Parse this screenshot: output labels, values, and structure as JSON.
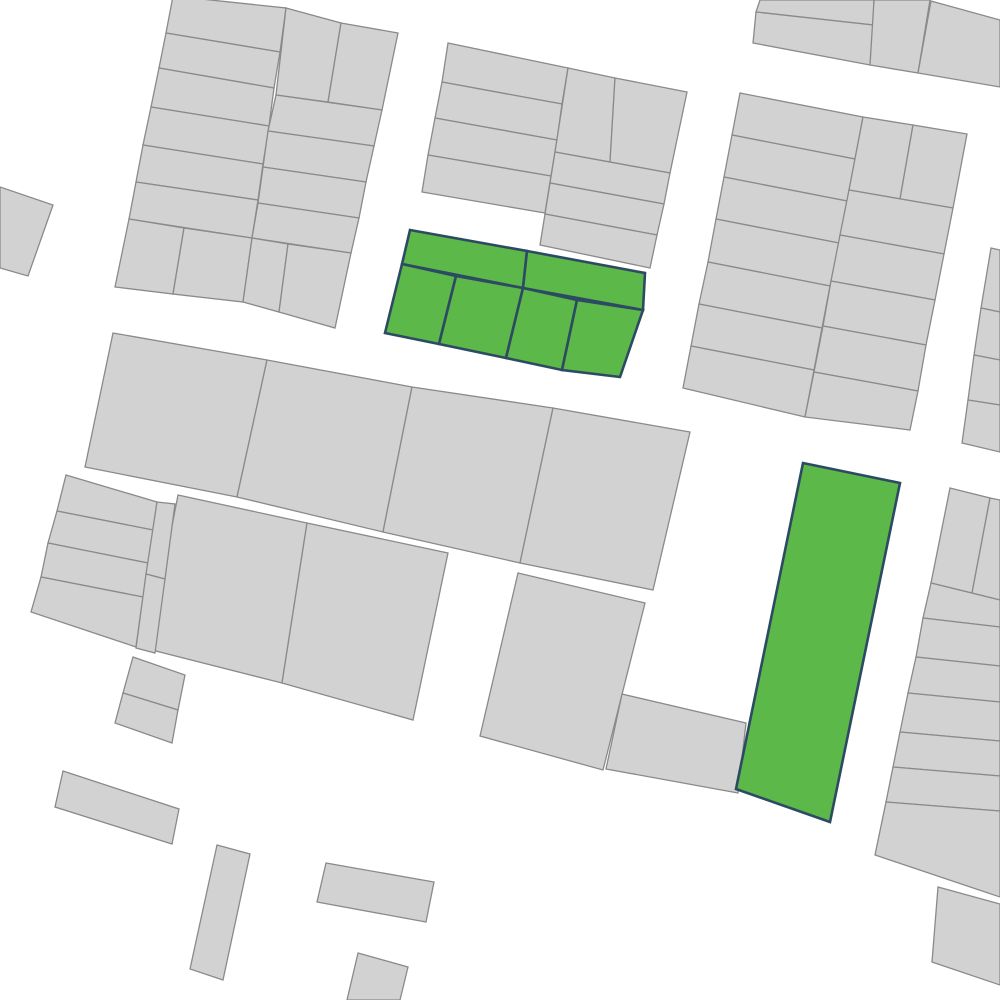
{
  "map": {
    "description": "cadastral-parcel-map",
    "background": "#ffffff",
    "colors": {
      "parcel_fill": "#d2d2d2",
      "parcel_stroke": "#8a8a8a",
      "highlight_fill": "#5cb848",
      "highlight_stroke": "#2d4a63"
    },
    "stroke": {
      "parcel_width": 1.3,
      "highlight_width": 2.6
    },
    "parcels": [
      {
        "id": "west-edge-1",
        "type": "standard",
        "points": "0,187 53,205 28,276 0,268"
      },
      {
        "id": "block-a-left-s1",
        "type": "standard",
        "points": "173,-4 286,8 280,52 166,33"
      },
      {
        "id": "block-a-left-s2",
        "type": "standard",
        "points": "166,33 280,52 274,88 159,68"
      },
      {
        "id": "block-a-left-s3",
        "type": "standard",
        "points": "159,68 274,88 269,126 151,107"
      },
      {
        "id": "block-a-left-s4",
        "type": "standard",
        "points": "151,107 269,126 263,164 143,145"
      },
      {
        "id": "block-a-left-s5",
        "type": "standard",
        "points": "143,145 263,164 258,200 136,182"
      },
      {
        "id": "block-a-left-s6",
        "type": "standard",
        "points": "136,182 258,200 252,238 129,219"
      },
      {
        "id": "block-a-left-b1",
        "type": "standard",
        "points": "129,219 184,228 173,294 115,287"
      },
      {
        "id": "block-a-left-b2",
        "type": "standard",
        "points": "184,228 252,238 243,302 173,294"
      },
      {
        "id": "block-a-right-p1",
        "type": "standard",
        "points": "286,8 341,23 328,102 276,95"
      },
      {
        "id": "block-a-right-p2",
        "type": "standard",
        "points": "341,23 398,33 382,110 328,102"
      },
      {
        "id": "block-a-right-s1",
        "type": "standard",
        "points": "276,95 382,110 374,146 268,131"
      },
      {
        "id": "block-a-right-s2",
        "type": "standard",
        "points": "268,131 374,146 366,182 263,167"
      },
      {
        "id": "block-a-right-s3",
        "type": "standard",
        "points": "263,167 366,182 359,218 258,203"
      },
      {
        "id": "block-a-right-s4",
        "type": "standard",
        "points": "258,203 359,218 351,253 252,238"
      },
      {
        "id": "block-a-right-b1",
        "type": "standard",
        "points": "252,238 288,244 279,312 243,302"
      },
      {
        "id": "block-a-right-b2",
        "type": "standard",
        "points": "288,244 351,253 335,328 279,312"
      },
      {
        "id": "block-b-left-s1",
        "type": "standard",
        "points": "448,43 568,68 562,104 442,82"
      },
      {
        "id": "block-b-left-s2",
        "type": "standard",
        "points": "442,82 562,104 557,140 435,118"
      },
      {
        "id": "block-b-left-s3",
        "type": "standard",
        "points": "435,118 557,140 551,176 428,155"
      },
      {
        "id": "block-b-left-s4",
        "type": "standard",
        "points": "428,155 551,176 545,213 422,192"
      },
      {
        "id": "block-b-right-p1",
        "type": "standard",
        "points": "568,68 615,78 610,162 555,152"
      },
      {
        "id": "block-b-right-p2",
        "type": "standard",
        "points": "615,78 687,92 670,173 610,162"
      },
      {
        "id": "block-b-right-s1",
        "type": "standard",
        "points": "555,152 670,173 664,204 550,183"
      },
      {
        "id": "block-b-right-s2",
        "type": "standard",
        "points": "550,183 664,204 657,235 545,214"
      },
      {
        "id": "block-b-right-s3",
        "type": "standard",
        "points": "545,214 657,235 650,268 540,245"
      },
      {
        "id": "block-ne-top-s1",
        "type": "standard",
        "points": "760,0 874,0 873,25 756,12"
      },
      {
        "id": "block-ne-top-s2",
        "type": "standard",
        "points": "756,12 873,25 870,65 753,43"
      },
      {
        "id": "block-ne-top-p1",
        "type": "standard",
        "points": "874,0 930,0 918,73 870,65"
      },
      {
        "id": "block-ne-top-p2",
        "type": "standard",
        "points": "931,1 1000,20 1000,87 918,73"
      },
      {
        "id": "block-e-left-s1",
        "type": "standard",
        "points": "740,93 863,117 855,159 732,135"
      },
      {
        "id": "block-e-left-s2",
        "type": "standard",
        "points": "732,135 855,159 847,201 724,177"
      },
      {
        "id": "block-e-left-s3",
        "type": "standard",
        "points": "724,177 847,201 839,243 716,219"
      },
      {
        "id": "block-e-left-s4",
        "type": "standard",
        "points": "716,219 839,243 830,286 708,262"
      },
      {
        "id": "block-e-left-s5",
        "type": "standard",
        "points": "708,262 830,286 822,328 699,304"
      },
      {
        "id": "block-e-left-s6",
        "type": "standard",
        "points": "699,304 822,328 814,370 691,346"
      },
      {
        "id": "block-e-left-s7",
        "type": "standard",
        "points": "691,346 814,370 805,417 683,388"
      },
      {
        "id": "block-e-right-p1",
        "type": "standard",
        "points": "863,117 913,125 900,199 849,190"
      },
      {
        "id": "block-e-right-p2",
        "type": "standard",
        "points": "913,125 967,134 953,208 900,199"
      },
      {
        "id": "block-e-right-s1",
        "type": "standard",
        "points": "849,190 953,208 944,254 840,235"
      },
      {
        "id": "block-e-right-s2",
        "type": "standard",
        "points": "840,235 944,254 935,300 831,281"
      },
      {
        "id": "block-e-right-s3",
        "type": "standard",
        "points": "831,281 935,300 926,345 823,326"
      },
      {
        "id": "block-e-right-s4",
        "type": "standard",
        "points": "823,326 926,345 918,391 814,372"
      },
      {
        "id": "block-e-right-s5",
        "type": "standard",
        "points": "814,372 918,391 910,430 805,417"
      },
      {
        "id": "east-sliver-s1",
        "type": "standard",
        "points": "991,248 1000,250 1000,312 981,308"
      },
      {
        "id": "east-sliver-s2",
        "type": "standard",
        "points": "981,308 1000,312 1000,360 974,355"
      },
      {
        "id": "east-sliver-s3",
        "type": "standard",
        "points": "974,355 1000,360 1000,405 968,400"
      },
      {
        "id": "east-sliver-s4",
        "type": "standard",
        "points": "968,400 1000,405 1000,452 962,443"
      },
      {
        "id": "mid-row1-1",
        "type": "standard",
        "points": "113,333 267,360 237,497 85,467"
      },
      {
        "id": "mid-row1-2",
        "type": "standard",
        "points": "267,360 412,387 383,532 237,497"
      },
      {
        "id": "mid-row1-3",
        "type": "standard",
        "points": "412,387 553,408 520,563 383,532"
      },
      {
        "id": "mid-row1-4",
        "type": "standard",
        "points": "553,408 690,432 653,590 520,563"
      },
      {
        "id": "mid-row2-1",
        "type": "standard",
        "points": "178,495 307,523 282,683 148,649"
      },
      {
        "id": "mid-row2-2",
        "type": "standard",
        "points": "307,523 448,553 413,720 282,683"
      },
      {
        "id": "west-strips-s1",
        "type": "standard",
        "points": "66,475 157,502 153,530 57,511"
      },
      {
        "id": "west-strips-s2",
        "type": "standard",
        "points": "57,511 153,530 148,563 48,543"
      },
      {
        "id": "west-strips-s3",
        "type": "standard",
        "points": "48,543 148,563 143,597 41,577"
      },
      {
        "id": "west-strips-s4",
        "type": "standard",
        "points": "41,577 143,597 136,647 31,612"
      },
      {
        "id": "west-column-1",
        "type": "standard",
        "points": "157,502 175,504 165,579 146,574"
      },
      {
        "id": "west-column-2",
        "type": "standard",
        "points": "146,574 165,579 155,653 136,648"
      },
      {
        "id": "west-small-1",
        "type": "standard",
        "points": "133,657 185,675 178,710 123,693"
      },
      {
        "id": "west-small-2",
        "type": "standard",
        "points": "123,693 178,710 172,743 115,723"
      },
      {
        "id": "south-center-big",
        "type": "standard",
        "points": "518,573 645,603 603,770 480,736"
      },
      {
        "id": "south-center-ext",
        "type": "standard",
        "points": "622,694 746,723 738,793 606,769"
      },
      {
        "id": "se-block-p1",
        "type": "standard",
        "points": "950,488 990,498 972,593 931,583"
      },
      {
        "id": "se-block-p2",
        "type": "standard",
        "points": "990,498 1000,500 1000,600 972,593"
      },
      {
        "id": "se-block-s1",
        "type": "standard",
        "points": "931,583 1000,600 1000,627 923,618"
      },
      {
        "id": "se-block-s2",
        "type": "standard",
        "points": "923,618 1000,627 1000,666 916,657"
      },
      {
        "id": "se-block-s3",
        "type": "standard",
        "points": "916,657 1000,666 1000,702 908,693"
      },
      {
        "id": "se-block-s4",
        "type": "standard",
        "points": "908,693 1000,702 1000,741 900,732"
      },
      {
        "id": "se-block-s5",
        "type": "standard",
        "points": "900,732 1000,741 1000,776 893,767"
      },
      {
        "id": "se-block-s6",
        "type": "standard",
        "points": "893,767 1000,776 1000,811 886,802"
      },
      {
        "id": "se-block-bottom",
        "type": "standard",
        "points": "886,802 1000,811 1000,897 875,855"
      },
      {
        "id": "se-corner",
        "type": "standard",
        "points": "938,887 1000,904 1000,985 932,962"
      },
      {
        "id": "south-bar-1",
        "type": "standard",
        "points": "63,771 179,809 172,844 55,807"
      },
      {
        "id": "south-bar-2",
        "type": "standard",
        "points": "217,845 250,854 223,980 190,969"
      },
      {
        "id": "south-bar-3",
        "type": "standard",
        "points": "326,863 434,882 426,922 317,902"
      },
      {
        "id": "south-bar-4",
        "type": "standard",
        "points": "358,953 408,967 400,1000 347,1000"
      },
      {
        "id": "highlight-a-top-left",
        "type": "highlight",
        "points": "410,230 527,251 523,288 402,264"
      },
      {
        "id": "highlight-a-top-right",
        "type": "highlight",
        "points": "527,251 645,273 643,310 523,288"
      },
      {
        "id": "highlight-a-bottom-1",
        "type": "highlight",
        "points": "402,264 456,276 439,344 385,333"
      },
      {
        "id": "highlight-a-bottom-2",
        "type": "highlight",
        "points": "456,276 523,288 506,358 439,344"
      },
      {
        "id": "highlight-a-bottom-3",
        "type": "highlight",
        "points": "523,288 577,300 562,370 506,358"
      },
      {
        "id": "highlight-a-bottom-4",
        "type": "highlight",
        "points": "577,300 643,310 620,377 562,370"
      },
      {
        "id": "highlight-b-strip",
        "type": "highlight",
        "points": "803,463 900,483 830,822 736,789"
      }
    ]
  }
}
